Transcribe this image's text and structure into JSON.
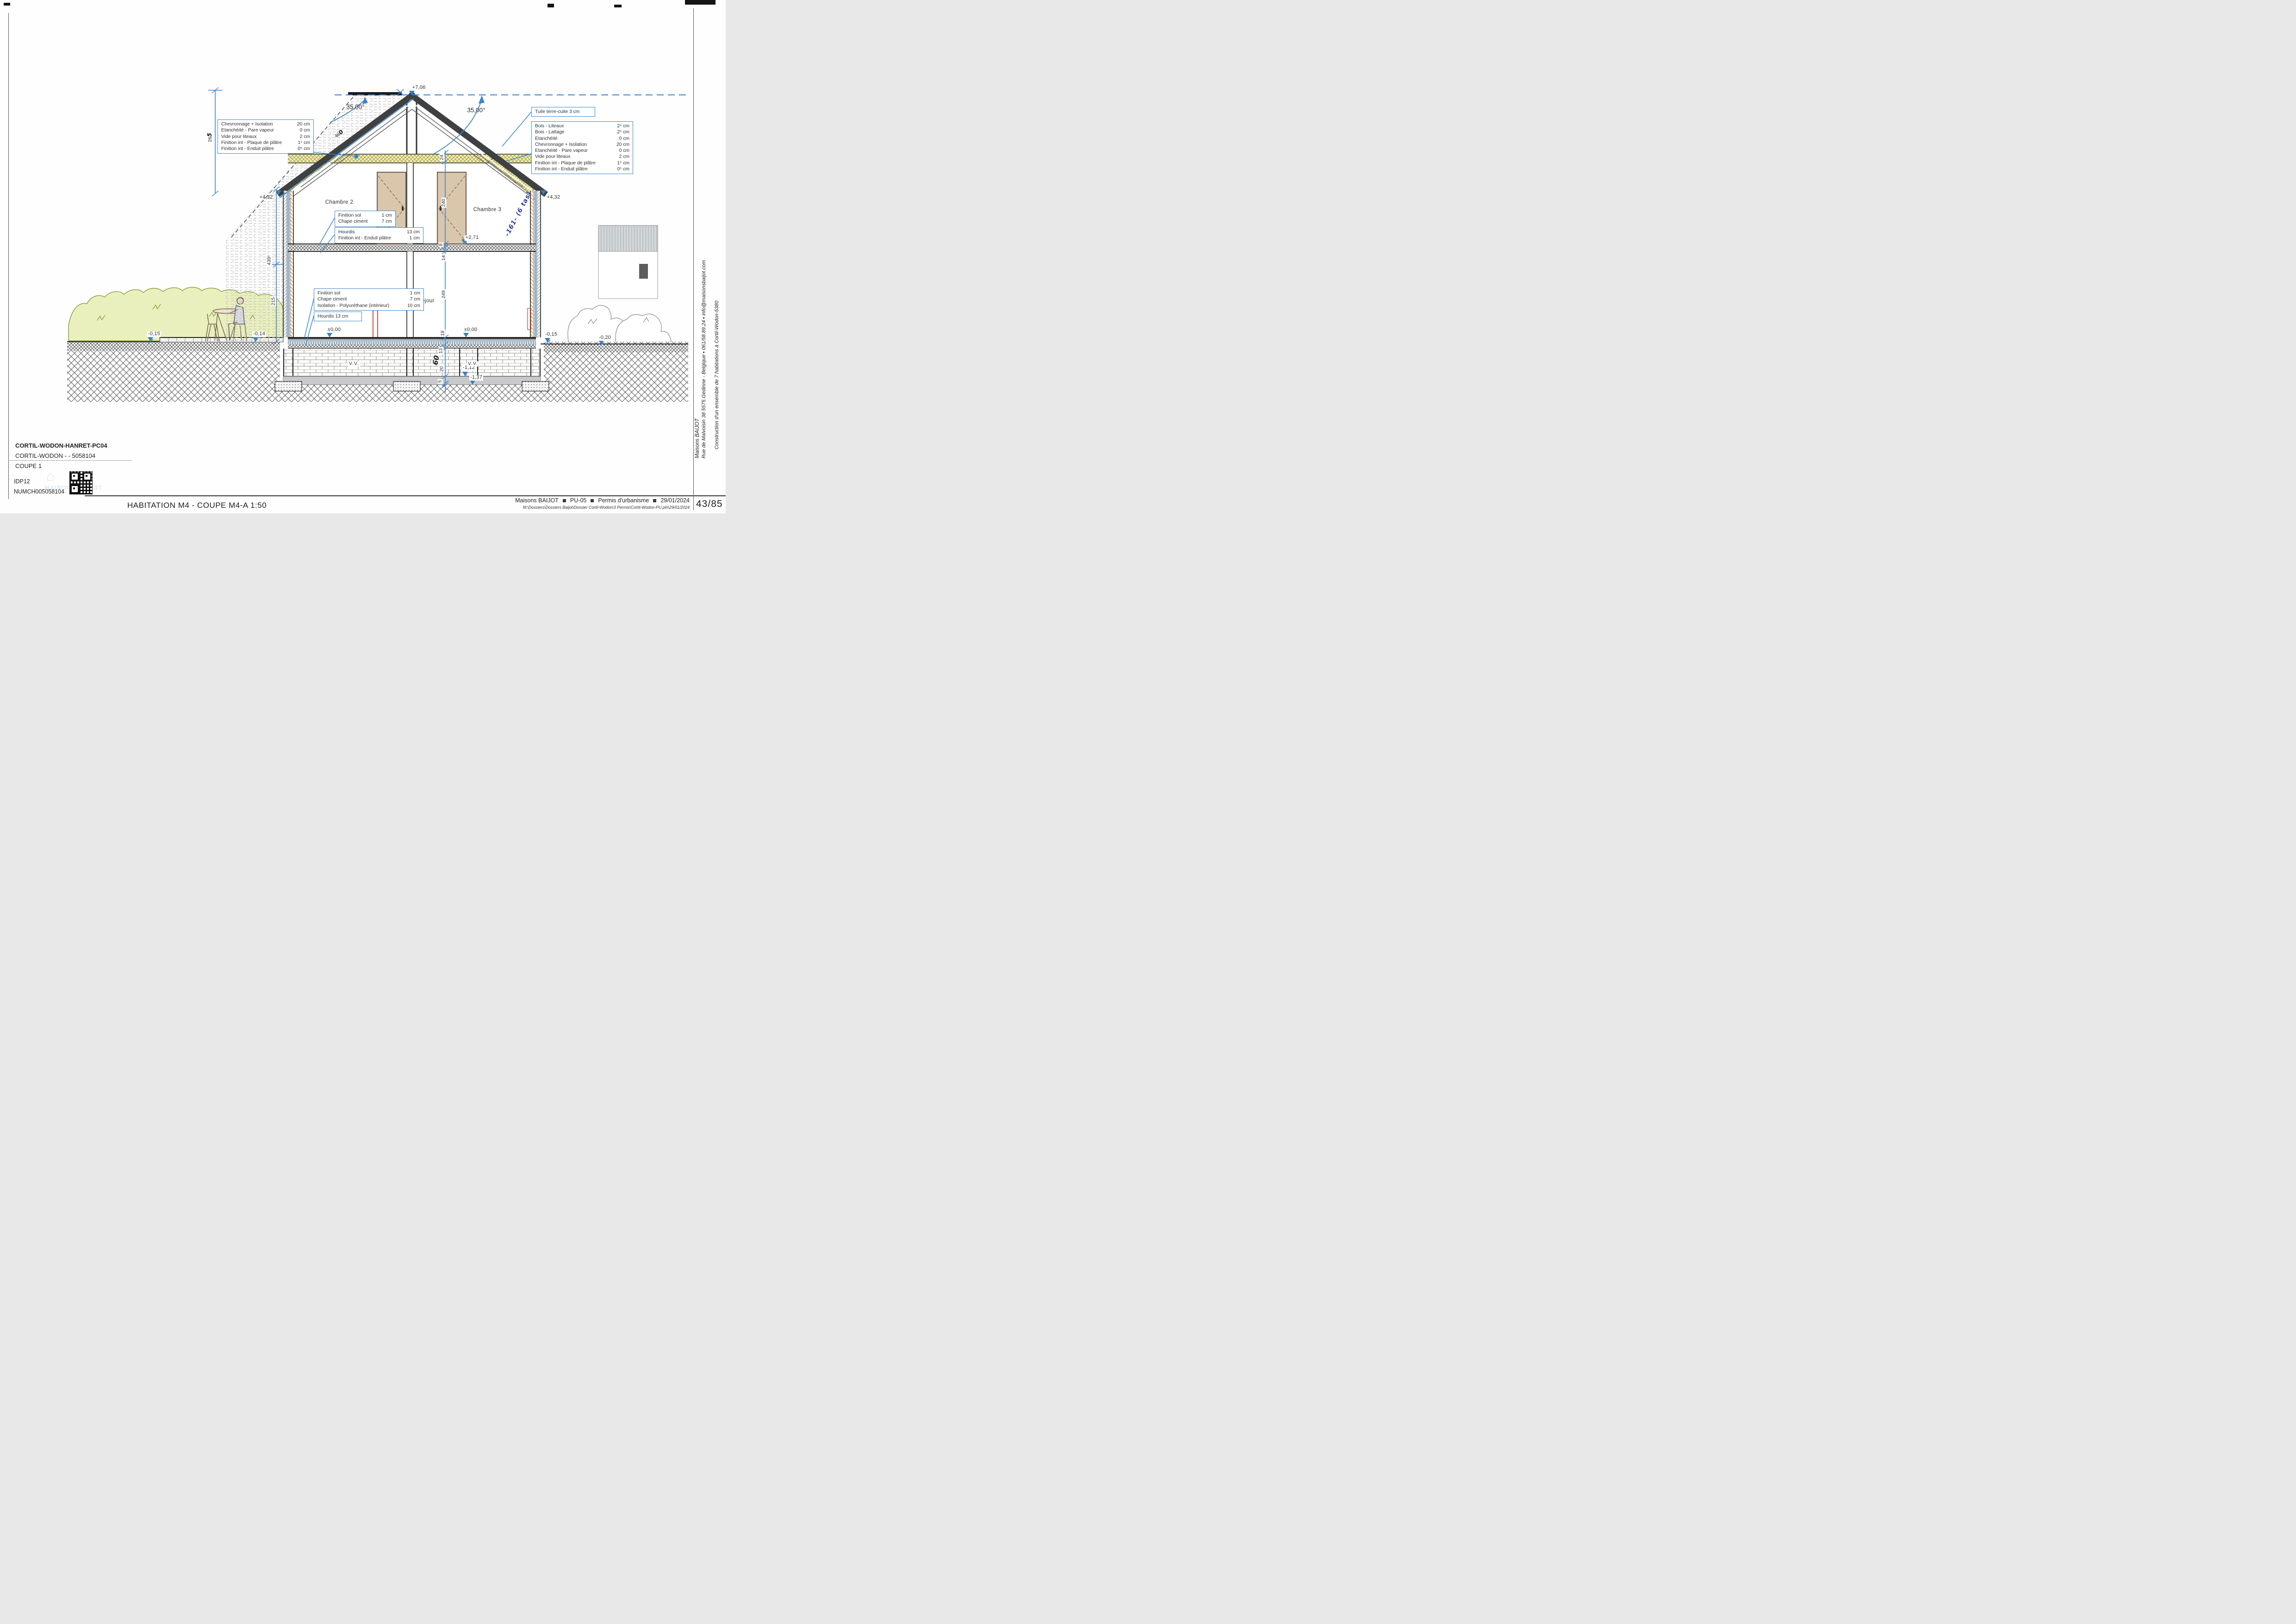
{
  "titleblock": {
    "project_code": "CORTIL-WODON-HANRET-PC04",
    "project_ref": "CORTIL-WODON -  - 5058104",
    "sheet_name": "COUPE 1",
    "idp": "IDP12",
    "num": "NUMCH005058104"
  },
  "drawing_title": "HABITATION M4 - COUPE M4-A 1:50",
  "footer": {
    "company": "Maisons BAIJOT",
    "doc_code": "PU-05",
    "doc_type": "Permis d'urbanisme",
    "date": "29/01/2024",
    "file_path": "M:\\Dossiers\\Dossiers Baijot\\Dossier Cortil-Wodon\\3 Permis\\Cortil-Wodon-PU.pln\\29/01/2024",
    "page": "43/85"
  },
  "margin": {
    "company": "Maisons BAIJOT",
    "address": "Rue de Malvoisin 38 5575 Gedinne - Belgique ▪ 061/58.89.24 ▪ info@maisonsbaijot.com",
    "project": "Construction d'un ensemble de 7 habitations à Cortil-Wodon-5380"
  },
  "levels": {
    "ridge": "+7,06",
    "attic_left": "+4,32",
    "attic_right": "+4,32",
    "first_floor": "+2,71",
    "ground_left": "±0,00",
    "ground_right": "±0,00",
    "terrain_far_left": "-0,15",
    "terrace_left": "-0,14",
    "path_right": "-0,15",
    "terrain_far_right": "-0,20",
    "crawl_top": "-1,12",
    "foundation_base": "-1,37"
  },
  "angles": {
    "left": "35,00°",
    "right": "35,00°"
  },
  "rooms": {
    "bedroom2": "Chambre 2",
    "bedroom3": "Chambre 3",
    "living": "Séjour"
  },
  "voids": {
    "left": "V.V.",
    "right": "V.V."
  },
  "dims": {
    "chain": [
      "24",
      "240",
      "8",
      "14",
      "249",
      "18",
      "13",
      "20",
      "5"
    ],
    "facade_total": "439⁵",
    "facade_lower": "215",
    "gable_print": "26",
    "gable_hand": "5",
    "rafter_print": "46",
    "rafter_hand": "0",
    "hand_60": "60"
  },
  "handnote": "-161- (6 tas)",
  "callouts": {
    "roof_left": {
      "rows": [
        {
          "label": "Chevronnage + Isolation",
          "value": "20 cm"
        },
        {
          "label": "Etanchéité - Pare vapeur",
          "value": "0 cm"
        },
        {
          "label": "Vide pour liteaux",
          "value": "2 cm"
        },
        {
          "label": "Finition int - Plaque de plâtre",
          "value": "1⁵ cm"
        },
        {
          "label": "Finition int - Enduit plâtre",
          "value": "0⁵ cm"
        }
      ]
    },
    "tile": "Tuile terre-cuite 3 cm",
    "roof_right": {
      "rows": [
        {
          "label": "Bois - Liteaux",
          "value": "2⁵ cm"
        },
        {
          "label": "Bois - Lattage",
          "value": "2⁵ cm"
        },
        {
          "label": "Etanchéité",
          "value": "0 cm"
        },
        {
          "label": "Chevronnage + Isolation",
          "value": "20 cm"
        },
        {
          "label": "Etanchéité - Pare vapeur",
          "value": "0 cm"
        },
        {
          "label": "Vide pour liteaux",
          "value": "2 cm"
        },
        {
          "label": "Finition int - Plaque de plâtre",
          "value": "1⁵ cm"
        },
        {
          "label": "Finition int - Enduit plâtre",
          "value": "0⁵ cm"
        }
      ]
    },
    "floor1_top": {
      "rows": [
        {
          "label": "Finition sol",
          "value": "1 cm"
        },
        {
          "label": "Chape ciment",
          "value": "7 cm"
        }
      ]
    },
    "floor1_slab": {
      "rows": [
        {
          "label": "Hourdis",
          "value": "13 cm"
        },
        {
          "label": "Finition int - Enduit plâtre",
          "value": "1 cm"
        }
      ]
    },
    "floor0_top": {
      "rows": [
        {
          "label": "Finition sol",
          "value": "1 cm"
        },
        {
          "label": "Chape ciment",
          "value": "7 cm"
        },
        {
          "label": "Isolation - Polyuréthane (intérieur)",
          "value": "10 cm"
        }
      ]
    },
    "floor0_slab": "Hourdis 13 cm"
  }
}
